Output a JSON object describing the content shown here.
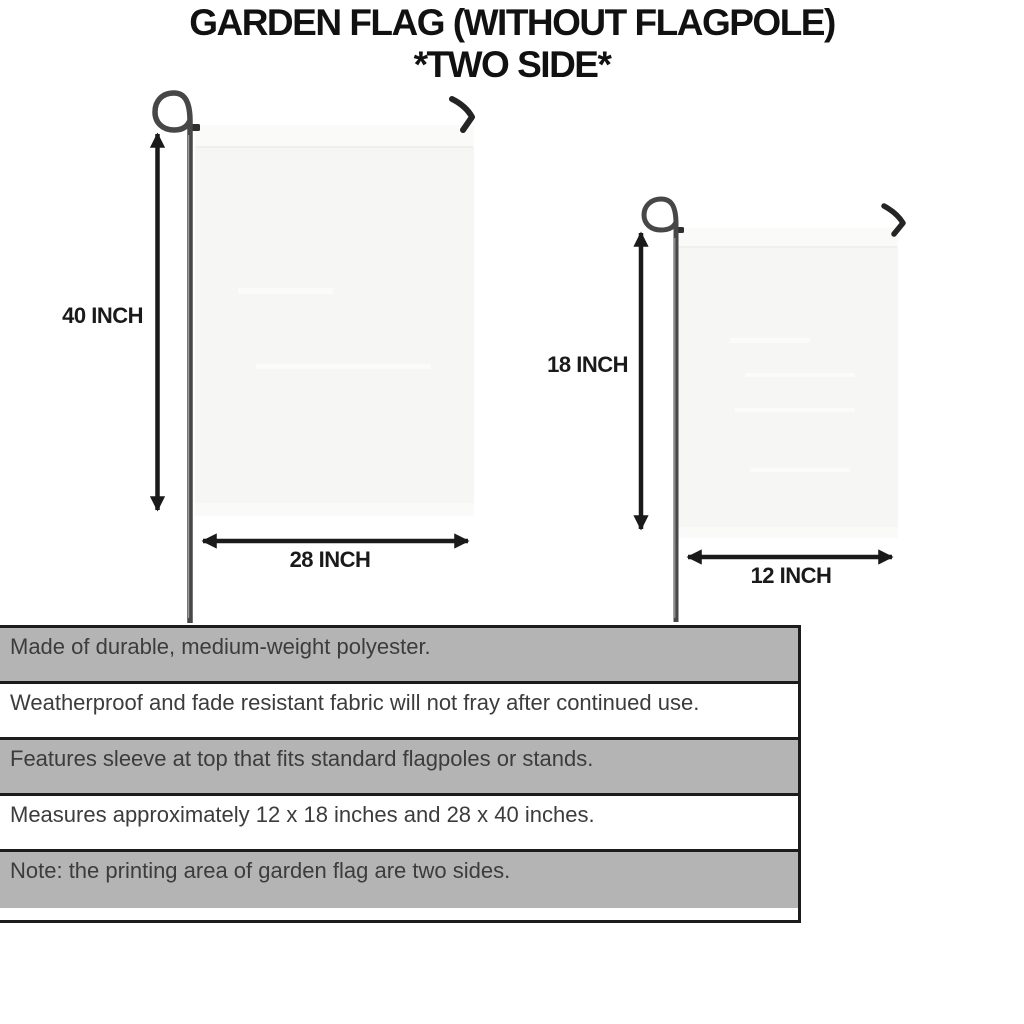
{
  "header": {
    "title_line1": "GARDEN FLAG (WITHOUT FLAGPOLE)",
    "title_line2": "*TWO SIDE*"
  },
  "diagram": {
    "large_flag": {
      "height_label": "40 INCH",
      "width_label": "28 INCH"
    },
    "small_flag": {
      "height_label": "18 INCH",
      "width_label": "12 INCH"
    }
  },
  "specs": {
    "rows": [
      "Made of durable, medium-weight polyester.",
      "Weatherproof and fade resistant fabric will not fray after continued use.",
      "Features sleeve at top that fits standard flagpoles or stands.",
      "Measures approximately 12 x 18 inches and 28 x 40 inches.",
      "Note: the printing area of garden flag are two sides."
    ]
  },
  "colors": {
    "page_bg": "#ffffff",
    "title_black": "#111111",
    "arrow_black": "#1a1a1a",
    "table_gray": "#b4b4b4",
    "table_white": "#ffffff",
    "border_black": "#1c1c1c",
    "text_dark": "#3c3c3c",
    "flag_fill": "#f6f6f4",
    "flag_sleeve": "#fafaf8",
    "streak": "#fbfbfa",
    "pole_gray": "#474747"
  }
}
